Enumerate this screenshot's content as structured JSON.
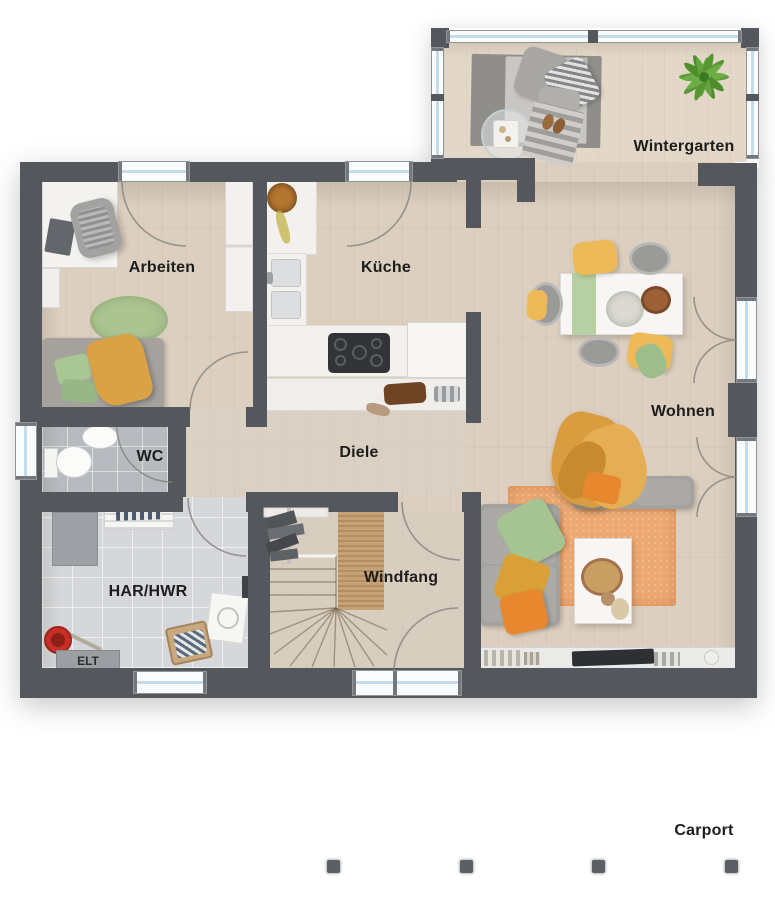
{
  "rooms": {
    "wintergarten": {
      "label": "Wintergarten"
    },
    "arbeiten": {
      "label": "Arbeiten"
    },
    "kueche": {
      "label": "Küche"
    },
    "wohnen": {
      "label": "Wohnen"
    },
    "wc": {
      "label": "WC"
    },
    "diele": {
      "label": "Diele"
    },
    "har_hwr": {
      "label": "HAR/HWR"
    },
    "windfang": {
      "label": "Windfang"
    },
    "elt": {
      "label": "ELT"
    },
    "carport": {
      "label": "Carport"
    }
  },
  "colors": {
    "wall": "#54575b",
    "wood_floor": "#dccfbf",
    "wintergarten_floor": "#e3d7c7",
    "wc_tiles": "#b7bbc0",
    "har_tiles": "#d5d7da",
    "window_glass": "#c6dcea",
    "accent_orange": "#e8872e",
    "accent_yellow": "#eeba57",
    "accent_green": "#a6c492",
    "label_text": "#1d1d1d"
  }
}
